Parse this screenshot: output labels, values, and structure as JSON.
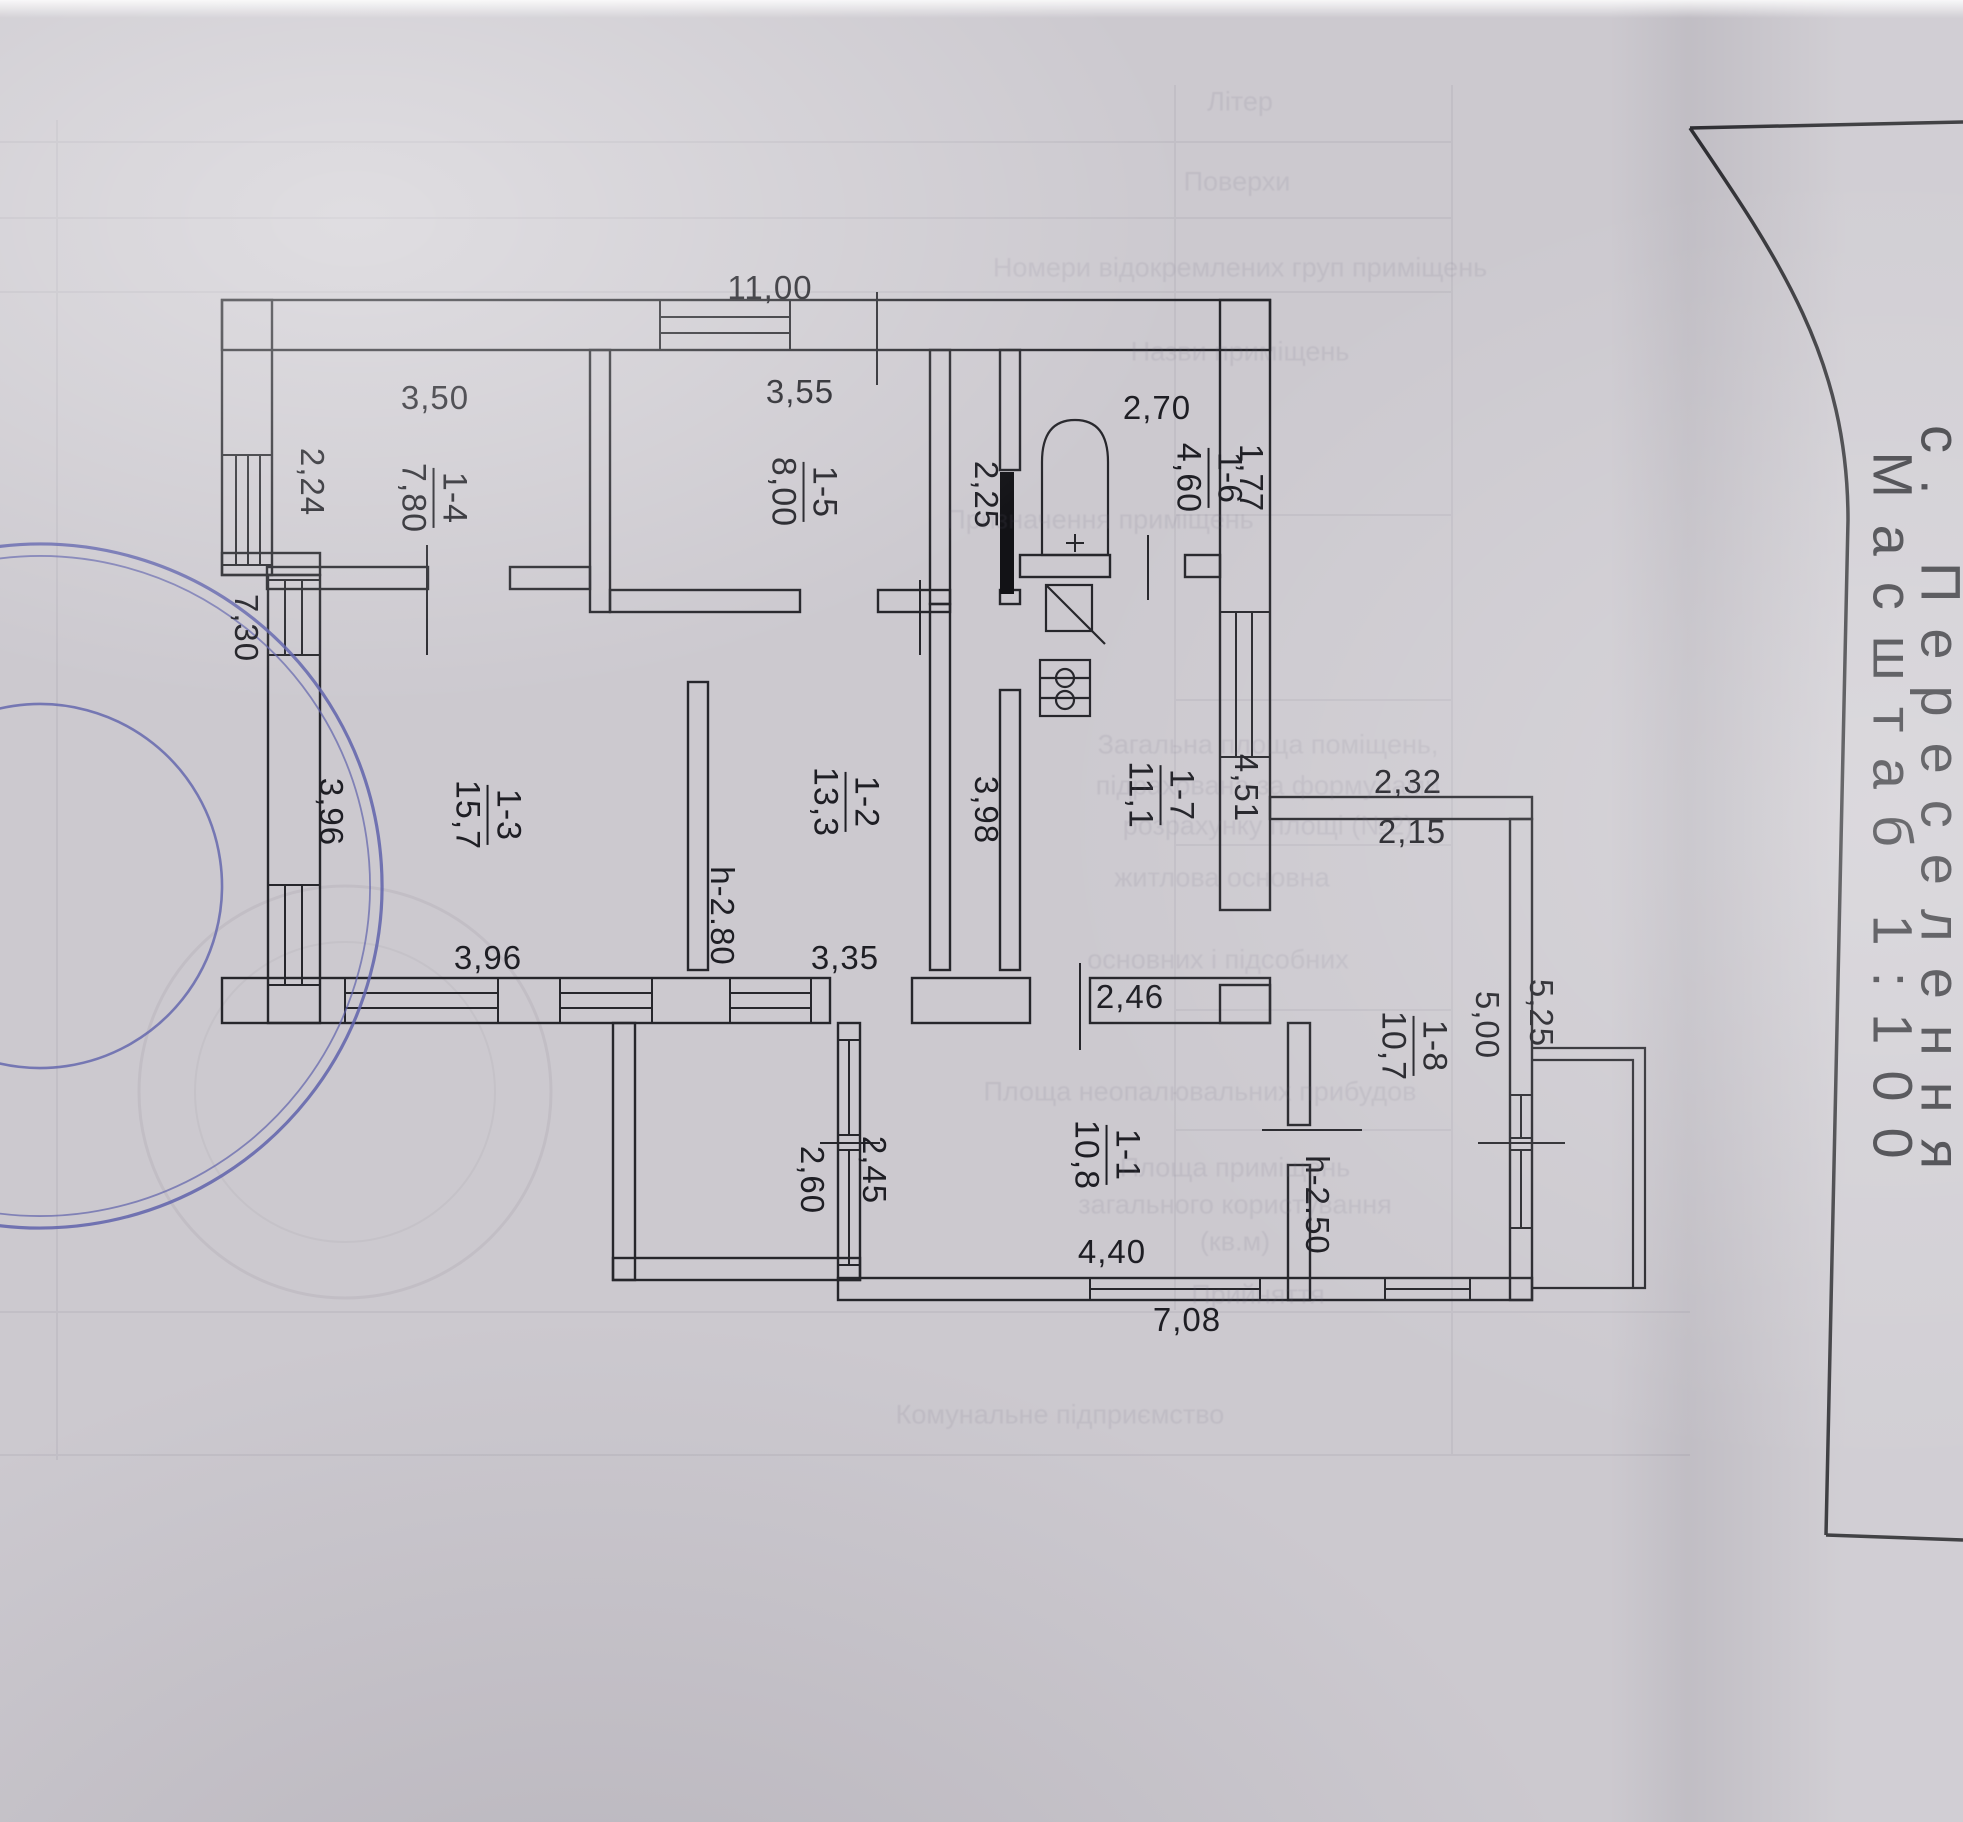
{
  "document": {
    "type": "floor-plan-scan",
    "title_settlement": "с. Переселення",
    "title_scale": "Масштаб 1:100"
  },
  "plan": {
    "rooms": [
      {
        "number": "1-4",
        "area": "7,80",
        "x": 433,
        "y": 498
      },
      {
        "number": "1-5",
        "area": "8,00",
        "x": 803,
        "y": 492
      },
      {
        "number": "1-6",
        "area": "4,60",
        "x": 1208,
        "y": 478
      },
      {
        "number": "1-7",
        "area": "11,1",
        "x": 1160,
        "y": 795
      },
      {
        "number": "1-2",
        "area": "13,3",
        "x": 845,
        "y": 802
      },
      {
        "number": "1-3",
        "area": "15,7",
        "x": 487,
        "y": 815
      },
      {
        "number": "1-1",
        "area": "10,8",
        "x": 1106,
        "y": 1155
      },
      {
        "number": "1-8",
        "area": "10,7",
        "x": 1413,
        "y": 1046
      }
    ],
    "dimensions": [
      {
        "t": "11,00",
        "x": 770,
        "y": 288,
        "r": 0
      },
      {
        "t": "3,50",
        "x": 435,
        "y": 398,
        "r": 0
      },
      {
        "t": "3,55",
        "x": 800,
        "y": 392,
        "r": 0
      },
      {
        "t": "2,70",
        "x": 1157,
        "y": 408,
        "r": 0
      },
      {
        "t": "1,77",
        "x": 1251,
        "y": 478,
        "r": 1
      },
      {
        "t": "2,25",
        "x": 986,
        "y": 495,
        "r": 1
      },
      {
        "t": "2,24",
        "x": 312,
        "y": 482,
        "r": 1
      },
      {
        "t": "7,30",
        "x": 246,
        "y": 628,
        "r": 1
      },
      {
        "t": "3,96",
        "x": 331,
        "y": 812,
        "r": 1
      },
      {
        "t": "3,96",
        "x": 488,
        "y": 958,
        "r": 0
      },
      {
        "t": "h-2.80",
        "x": 722,
        "y": 916,
        "r": 1
      },
      {
        "t": "3,35",
        "x": 845,
        "y": 958,
        "r": 0
      },
      {
        "t": "3,98",
        "x": 986,
        "y": 810,
        "r": 1
      },
      {
        "t": "4,51",
        "x": 1246,
        "y": 788,
        "r": 1
      },
      {
        "t": "2,46",
        "x": 1130,
        "y": 997,
        "r": 0
      },
      {
        "t": "2,32",
        "x": 1408,
        "y": 782,
        "r": 0
      },
      {
        "t": "2,15",
        "x": 1412,
        "y": 832,
        "r": 0
      },
      {
        "t": "2,60",
        "x": 812,
        "y": 1180,
        "r": 1
      },
      {
        "t": "2,45",
        "x": 874,
        "y": 1170,
        "r": 1
      },
      {
        "t": "4,40",
        "x": 1112,
        "y": 1252,
        "r": 0
      },
      {
        "t": "7,08",
        "x": 1187,
        "y": 1320,
        "r": 0
      },
      {
        "t": "h-2.50",
        "x": 1317,
        "y": 1205,
        "r": 1
      },
      {
        "t": "5,00",
        "x": 1487,
        "y": 1025,
        "r": 1
      },
      {
        "t": "5,25",
        "x": 1541,
        "y": 1013,
        "r": 1
      }
    ],
    "fixtures": [
      "bathtub",
      "sink",
      "stove",
      "door-leaf",
      "porch"
    ]
  },
  "stamp": {
    "ring_outer": "дарства України ✱ Міністерство регіонального розв",
    "ring_middle": "йна архітектурно-будівельна інспекція",
    "ring_inner": "✱ У К Р А Ї Н А ✱",
    "ring_bottom": "державний архітектурно-будівельний контроль",
    "color": "#5f63ab"
  },
  "bleed_texts": [
    {
      "t": "Літер",
      "x": 1240,
      "y": 102
    },
    {
      "t": "Поверхи",
      "x": 1237,
      "y": 182
    },
    {
      "t": "Номери відокремлених груп приміщень",
      "x": 1240,
      "y": 268
    },
    {
      "t": "Назви приміщень",
      "x": 1240,
      "y": 352
    },
    {
      "t": "Призначення приміщень",
      "x": 1100,
      "y": 520
    },
    {
      "t": "Загальна площа поміщень,",
      "x": 1268,
      "y": 745
    },
    {
      "t": "підрахована за формулами",
      "x": 1268,
      "y": 786
    },
    {
      "t": "розрахунку площі (№2)",
      "x": 1268,
      "y": 826
    },
    {
      "t": "житлова основна",
      "x": 1222,
      "y": 878
    },
    {
      "t": "основних і підсобних",
      "x": 1218,
      "y": 960
    },
    {
      "t": "Площа неопалювальних прибудов",
      "x": 1200,
      "y": 1092
    },
    {
      "t": "Площа приміщень",
      "x": 1235,
      "y": 1168
    },
    {
      "t": "загального користування",
      "x": 1235,
      "y": 1205
    },
    {
      "t": "(кв.м)",
      "x": 1235,
      "y": 1242
    },
    {
      "t": "Прийняття",
      "x": 1258,
      "y": 1295
    },
    {
      "t": "Комунальне підприємство",
      "x": 1060,
      "y": 1415
    }
  ]
}
